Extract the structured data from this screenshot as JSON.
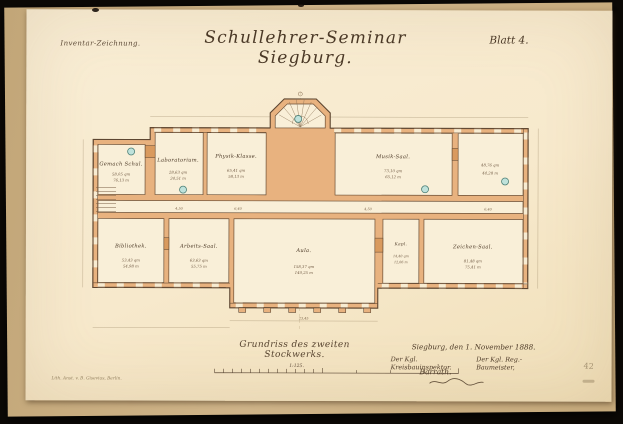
{
  "header": {
    "annotation": "Inventar-Zeichnung.",
    "title": "Schullehrer-Seminar Siegburg.",
    "sheet": "Blatt 4."
  },
  "plan": {
    "rooms": [
      {
        "label": "Gemach Schul.",
        "area": "58,05 qm",
        "len": "76,13 m"
      },
      {
        "label": "Laboratorium.",
        "area": "28,63 qm",
        "len": "24,51 m"
      },
      {
        "label": "Physik-Klasse.",
        "area": "65,41 qm",
        "len": "58,13 m"
      },
      {
        "label": "Musik-Saal.",
        "area": "73,10 qm",
        "len": "65,12 m"
      },
      {
        "label": "",
        "area": "48,76 qm",
        "len": "44,28 m"
      },
      {
        "label": "Bibliothek.",
        "area": "53,43 qm",
        "len": "54,98 m"
      },
      {
        "label": "Arbeits-Saal.",
        "area": "63,63 qm",
        "len": "55,75 m"
      },
      {
        "label": "Aula.",
        "area": "158,37 qm",
        "len": "140,25 m"
      },
      {
        "label": "Kapl.",
        "area": "14,40 qm",
        "len": "12,06 m"
      },
      {
        "label": "Zeichen-Saal.",
        "area": "81,48 qm",
        "len": "75,41 m"
      }
    ],
    "dims": [
      "4,50",
      "6,40",
      "4,50",
      "6,40",
      "23,45"
    ]
  },
  "caption": "Grundriss des zweiten Stockwerks.",
  "scale": {
    "label": "1:125."
  },
  "signature_block": {
    "place_date": "Siegburg, den 1. November 1888.",
    "title_left": "Der Kgl. Kreisbauinspektor.",
    "title_right": "Der Kgl. Reg.-Baumeister,",
    "name": "Barrath."
  },
  "imprint": "Lith. Anst. v. B. Gisevius, Berlin.",
  "margin_marks": {
    "number": "42"
  },
  "colors": {
    "paper": "#f8ecd2",
    "wall_fill": "#e8b27f",
    "ink": "#55422e",
    "teal_circle": "#bfe2db"
  }
}
